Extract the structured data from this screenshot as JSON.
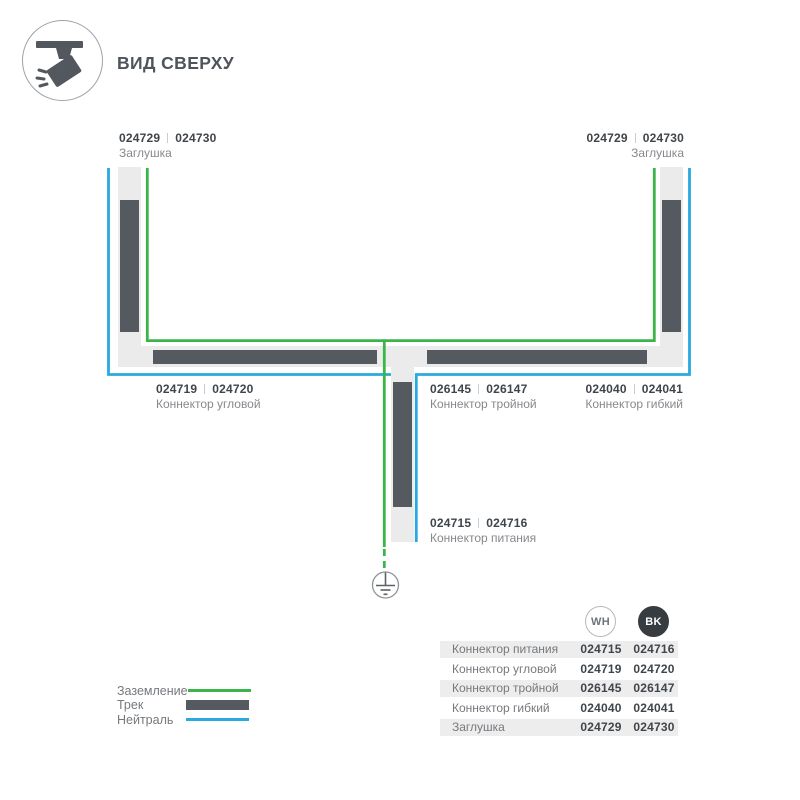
{
  "header": {
    "title": "ВИД СВЕРХУ"
  },
  "colors": {
    "ground_green": "#3bb54a",
    "neutral_blue": "#2aa9e0",
    "track_dark": "#545a60",
    "track_housing": "#ebebeb",
    "text_dark": "#3f454a",
    "text_gray": "#75797d"
  },
  "diagram": {
    "labels": {
      "endcap_left": {
        "code_wh": "024729",
        "code_bk": "024730",
        "name": "Заглушка"
      },
      "endcap_right": {
        "code_wh": "024729",
        "code_bk": "024730",
        "name": "Заглушка"
      },
      "corner": {
        "code_wh": "024719",
        "code_bk": "024720",
        "name": "Коннектор угловой"
      },
      "triple": {
        "code_wh": "026145",
        "code_bk": "026147",
        "name": "Коннектор тройной"
      },
      "flex": {
        "code_wh": "024040",
        "code_bk": "024041",
        "name": "Коннектор гибкий"
      },
      "power": {
        "code_wh": "024715",
        "code_bk": "024716",
        "name": "Коннектор питания"
      }
    }
  },
  "legend": {
    "items": [
      {
        "label": "Заземление",
        "swatch": "green-line"
      },
      {
        "label": "Трек",
        "swatch": "track-bar"
      },
      {
        "label": "Нейтраль",
        "swatch": "blue-line"
      }
    ]
  },
  "table": {
    "columns": [
      {
        "id": "wh",
        "label": "WH"
      },
      {
        "id": "bk",
        "label": "BK"
      }
    ],
    "rows": [
      {
        "name": "Коннектор питания",
        "wh": "024715",
        "bk": "024716"
      },
      {
        "name": "Коннектор угловой",
        "wh": "024719",
        "bk": "024720"
      },
      {
        "name": "Коннектор тройной",
        "wh": "026145",
        "bk": "026147"
      },
      {
        "name": "Коннектор гибкий",
        "wh": "024040",
        "bk": "024041"
      },
      {
        "name": "Заглушка",
        "wh": "024729",
        "bk": "024730"
      }
    ]
  }
}
